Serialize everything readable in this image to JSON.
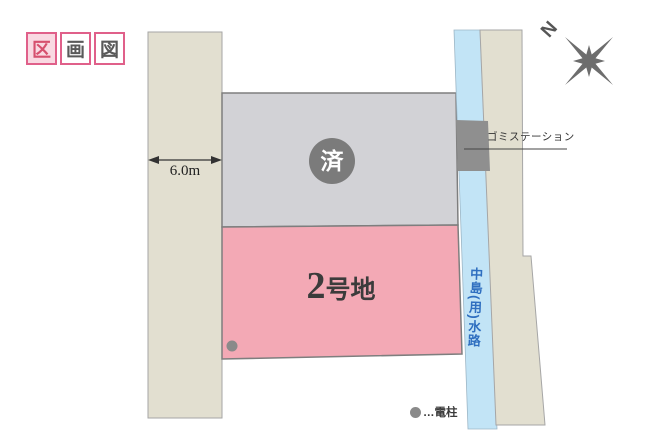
{
  "title": {
    "boxes": [
      "区",
      "画",
      "図"
    ]
  },
  "map": {
    "road": {
      "width_label": "6.0m"
    },
    "sold_lot": {
      "badge": "済"
    },
    "lot2": {
      "number": "2",
      "suffix": "号地"
    },
    "waterway": {
      "name": "中島(用)水路"
    },
    "garbage_station": {
      "label": "ゴミステーション"
    },
    "compass": {
      "north": "N"
    },
    "legend": {
      "utility_pole": "…電柱"
    }
  },
  "colors": {
    "road": "#e2dfd0",
    "sold_lot": "#d2d2d6",
    "lot2": "#f3a9b5",
    "waterway": "#c2e4f6",
    "east_strip": "#e2dfd0",
    "garbage_box": "#8f8f8f",
    "sold_badge": "#7b7b7b",
    "utility_pole": "#8a8a8a",
    "compass": "#6d6d6d",
    "title_accent": "#e0608a",
    "waterway_text": "#2f6fc0"
  }
}
